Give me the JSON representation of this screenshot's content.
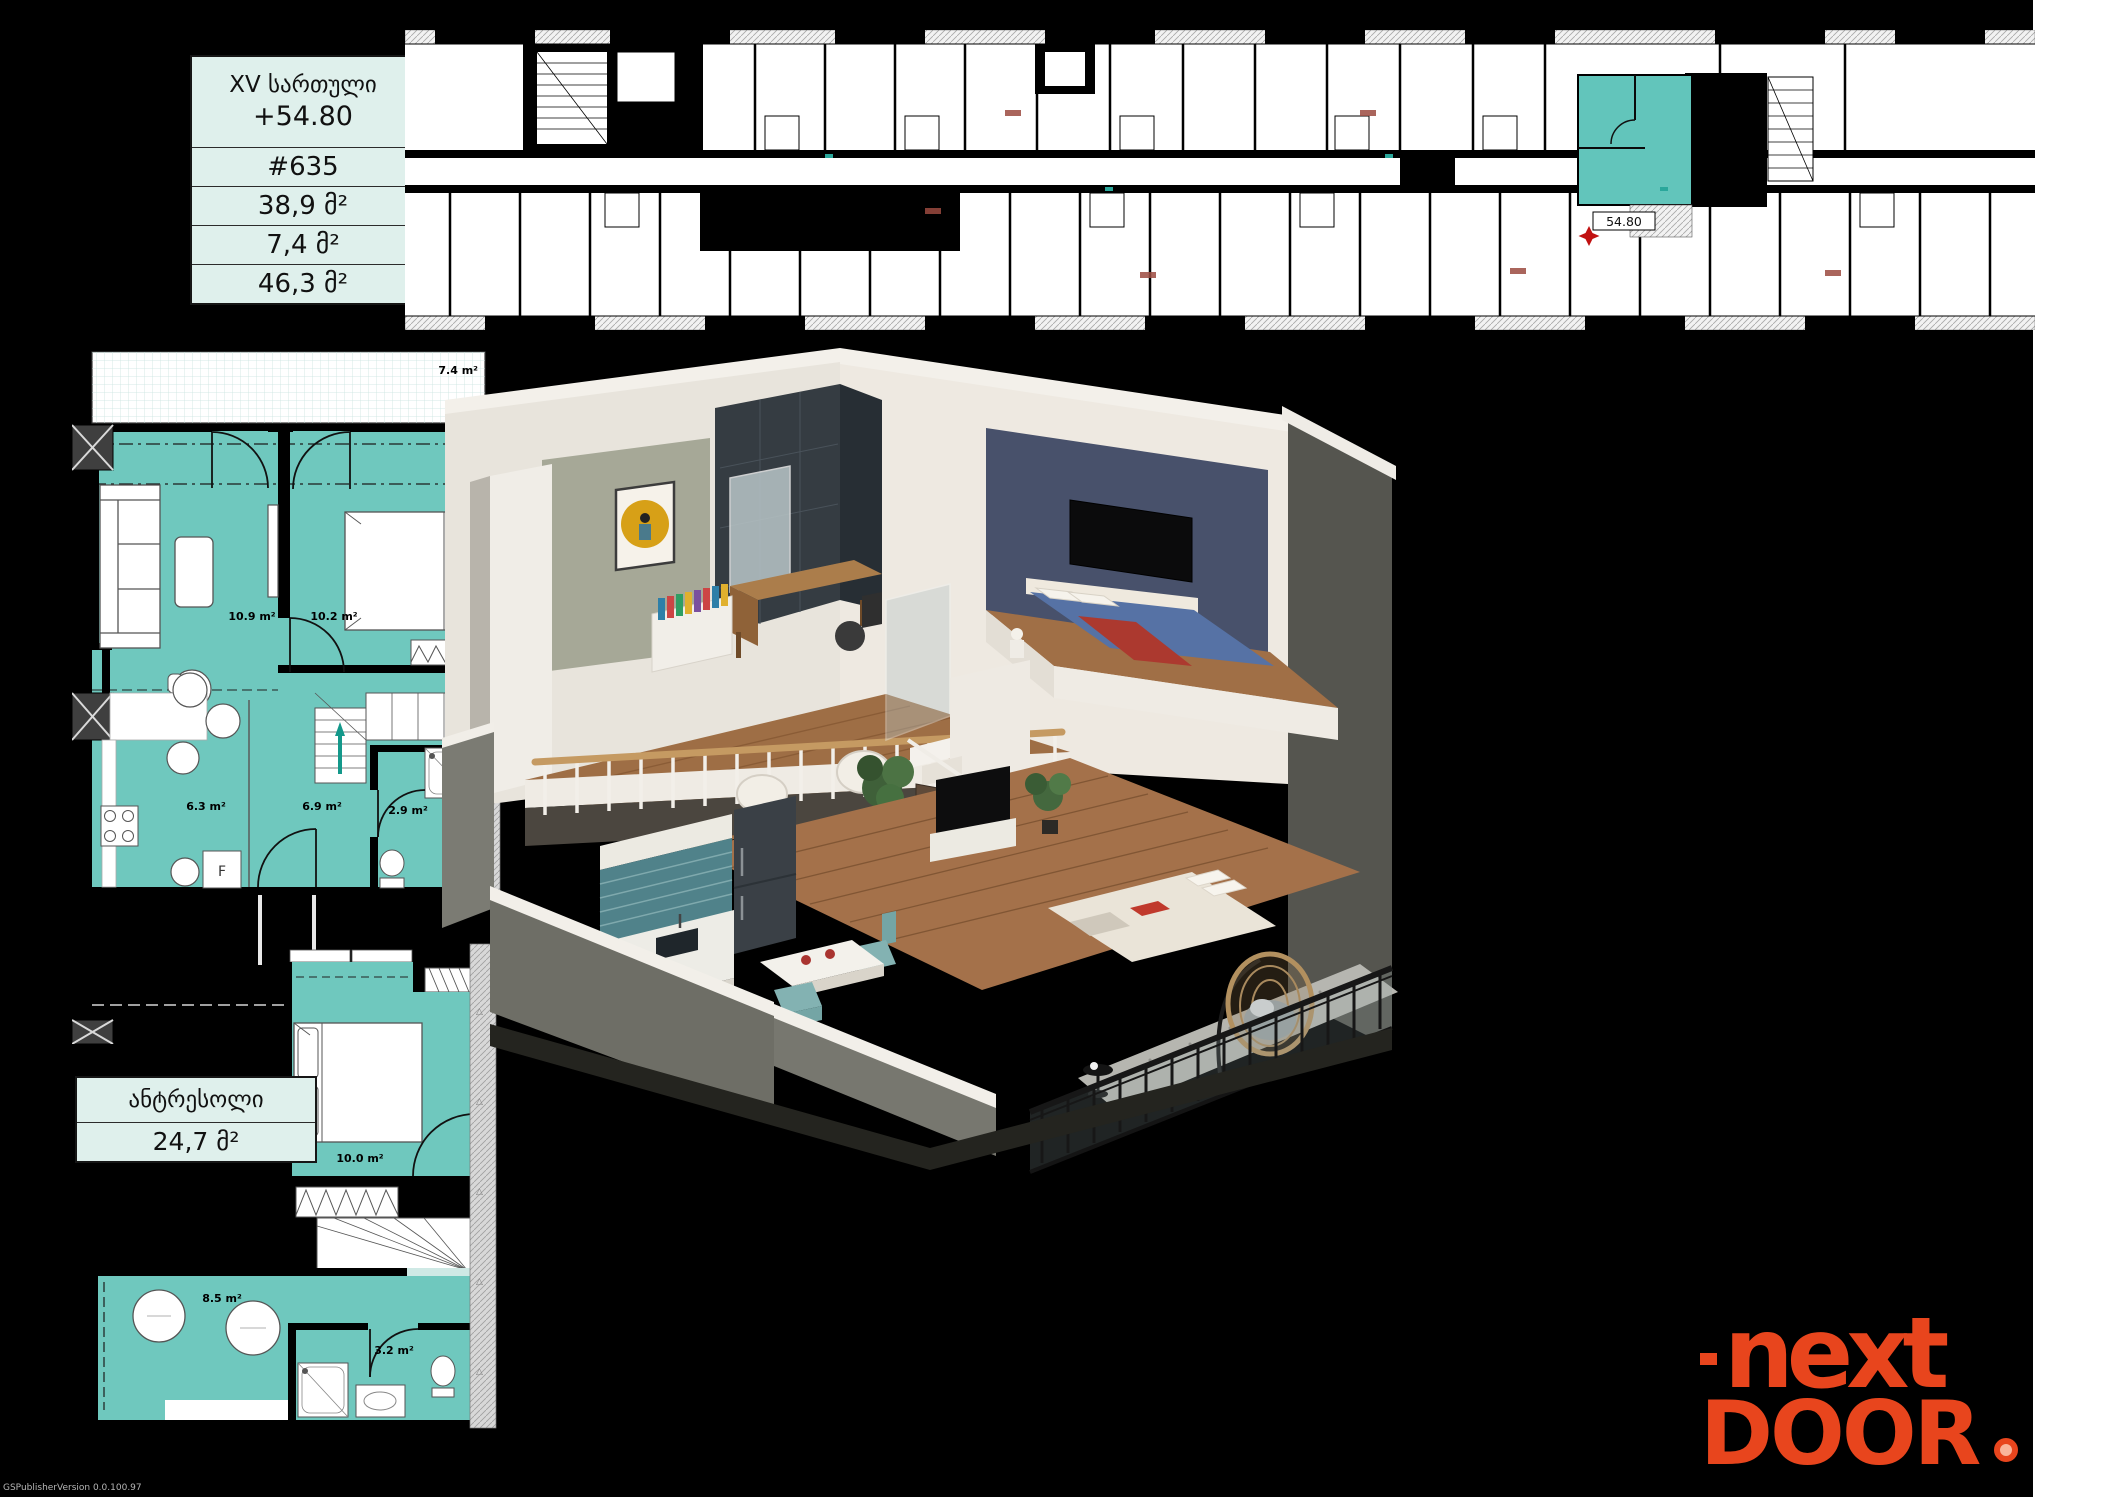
{
  "page": {
    "watermark": "GSPublisherVersion 0.0.100.97"
  },
  "info_table": {
    "floor": "XV სართული",
    "elevation": "+54.80",
    "unit": "#635",
    "area_main": "38,9 მ²",
    "area_balcony": "7,4 მ²",
    "area_total": "46,3 მ²"
  },
  "mezzanine_table": {
    "title": "ანტრესოლი",
    "area": "24,7 მ²"
  },
  "building_plan": {
    "marker": "54.80"
  },
  "main_plan": {
    "balcony": "7.4 m²",
    "living": "10.9 m²",
    "bedroom": "10.2 m²",
    "kitchen": "6.3 m²",
    "hall": "6.9 m²",
    "bath": "2.9 m²",
    "fridge": "F"
  },
  "mezz_plan": {
    "bedroom": "10.0 m²",
    "hall": "8.5 m²",
    "bath": "3.2 m²"
  },
  "logo": {
    "top": "next",
    "bottom": "DOOR"
  },
  "colors": {
    "plan_highlight": "#6fc8be",
    "building_highlight": "#62c5bb",
    "logo_orange": "#e8451d",
    "table_bg": "#dff0ec"
  }
}
